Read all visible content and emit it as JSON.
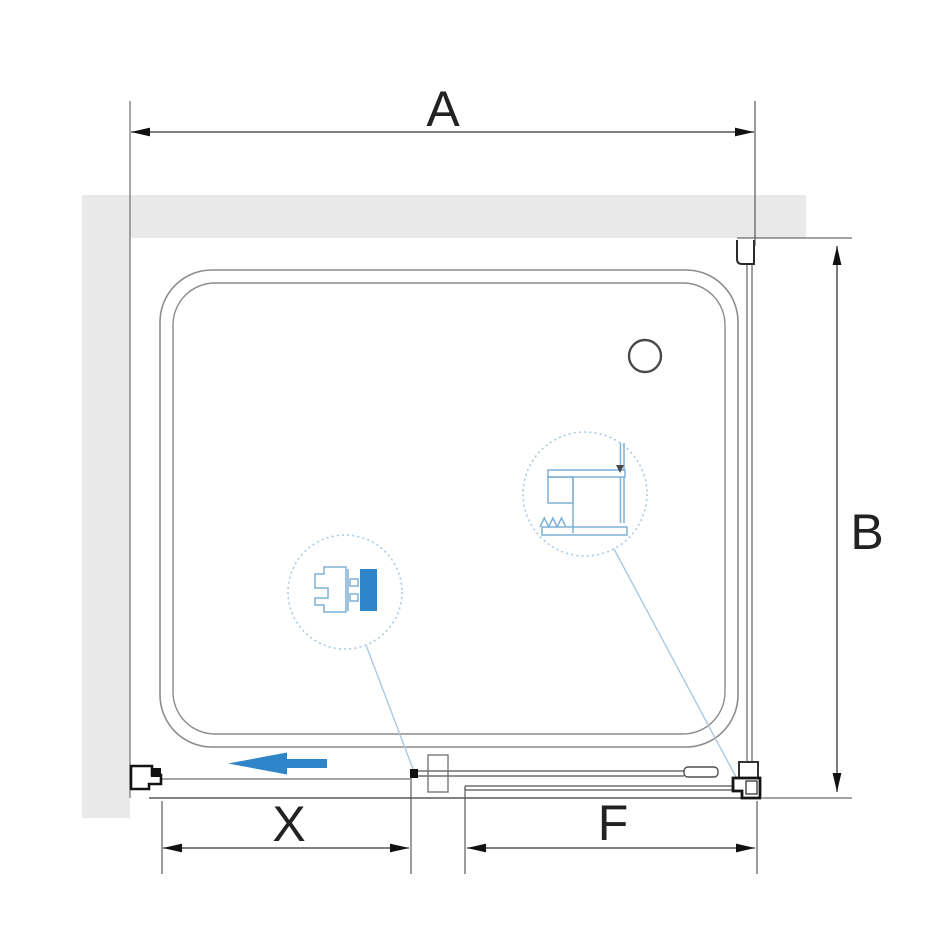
{
  "dimensions": {
    "width": {
      "label": "A"
    },
    "depth": {
      "label": "B"
    },
    "door": {
      "label": "X"
    },
    "fixed": {
      "label": "F"
    }
  },
  "colors": {
    "wall_fill": "#e9e9e9",
    "tray_line": "#8c8c8c",
    "dimension_line": "#333333",
    "arrowhead": "#111111",
    "bracket_black": "#141414",
    "arrow_blue": "#2e86c8",
    "profile_blue": "#7fb0d6",
    "callout_blue": "#a8c9e5"
  }
}
